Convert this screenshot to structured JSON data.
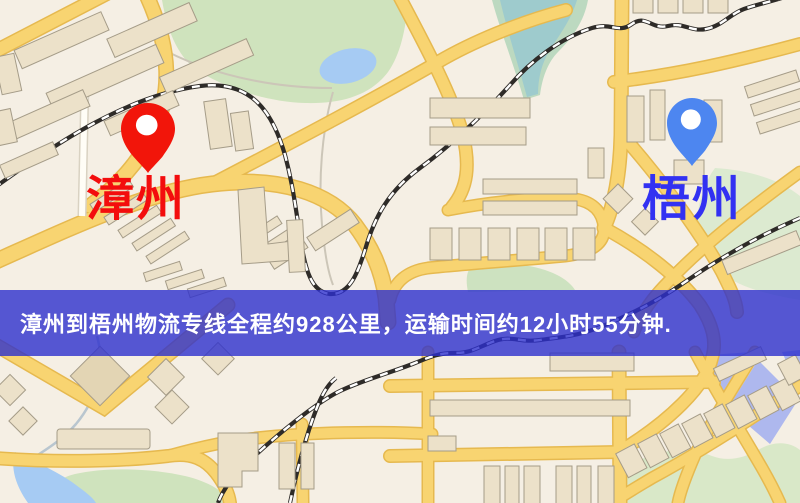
{
  "banner": {
    "text": "漳州到梧州物流专线全程约928公里，运输时间约12小时55分钟.",
    "bg_color": "rgba(45,48,205,0.80)",
    "text_color": "#ffffff"
  },
  "route": {
    "origin": "漳州",
    "destination": "梧州",
    "distance": "约928公里",
    "duration": "约12小时55分钟"
  },
  "markers": {
    "origin": {
      "label": "漳州",
      "pin_icon": "map-pin",
      "pin_color": "#f2150a",
      "label_color": "#f30d0d"
    },
    "destination": {
      "label": "梧州",
      "pin_icon": "map-pin",
      "pin_color": "#4d86f0",
      "label_color": "#3231f2"
    }
  },
  "map_style": {
    "background_color": "#f5efe4",
    "road_color": "#f8d471",
    "road_casing_color": "#e6b94f",
    "park_color": "#cfe3bd",
    "water_color": "#a6cbf3",
    "railway_color": "#2e2b28",
    "building_color": "#ece1c9"
  }
}
